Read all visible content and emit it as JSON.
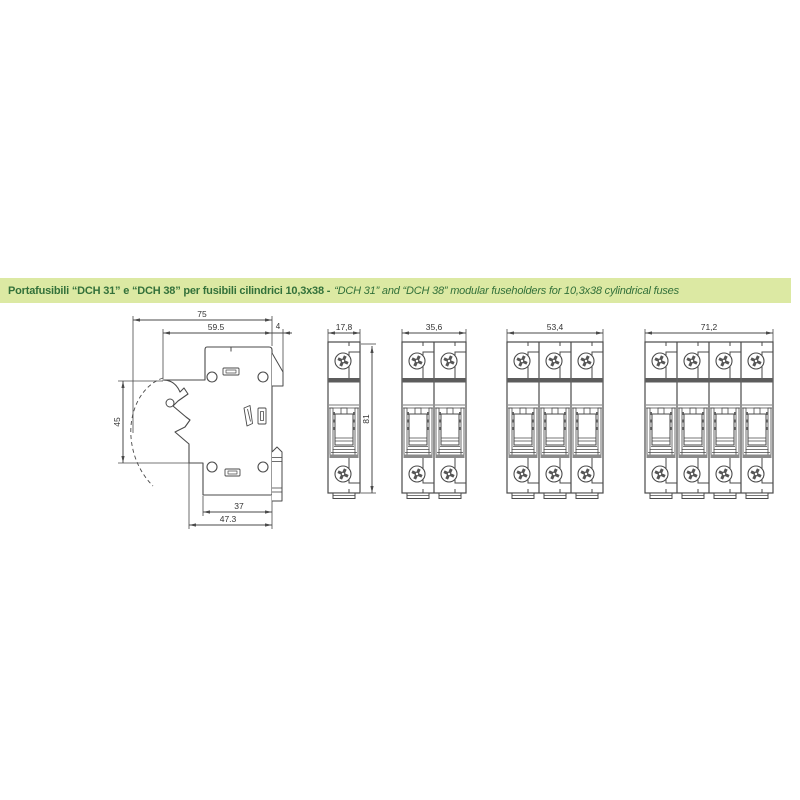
{
  "header": {
    "bar_color": "#dce9a3",
    "text_color": "#33713a",
    "title_it": "Portafusibili “DCH 31” e “DCH 38” per fusibili cilindrici 10,3x38 -",
    "title_en": "“DCH 31” and “DCH 38” modular fuseholders for 10,3x38 cylindrical fuses"
  },
  "drawings": {
    "line_color": "#4a4a4a",
    "dim_text_color": "#333333",
    "side_view": {
      "description": "side profile of fuseholder with door swing arc and DIN rail clip",
      "dims": {
        "total_width": "75",
        "upper_width": "59.5",
        "rail_lip": "4",
        "door_swing_height": "45",
        "base_width": "37",
        "base_total_width": "47.3"
      }
    },
    "front_views": [
      {
        "poles": 1,
        "width_label": "17,8",
        "height_label": "81"
      },
      {
        "poles": 2,
        "width_label": "35,6"
      },
      {
        "poles": 3,
        "width_label": "53,4"
      },
      {
        "poles": 4,
        "width_label": "71,2"
      }
    ]
  }
}
